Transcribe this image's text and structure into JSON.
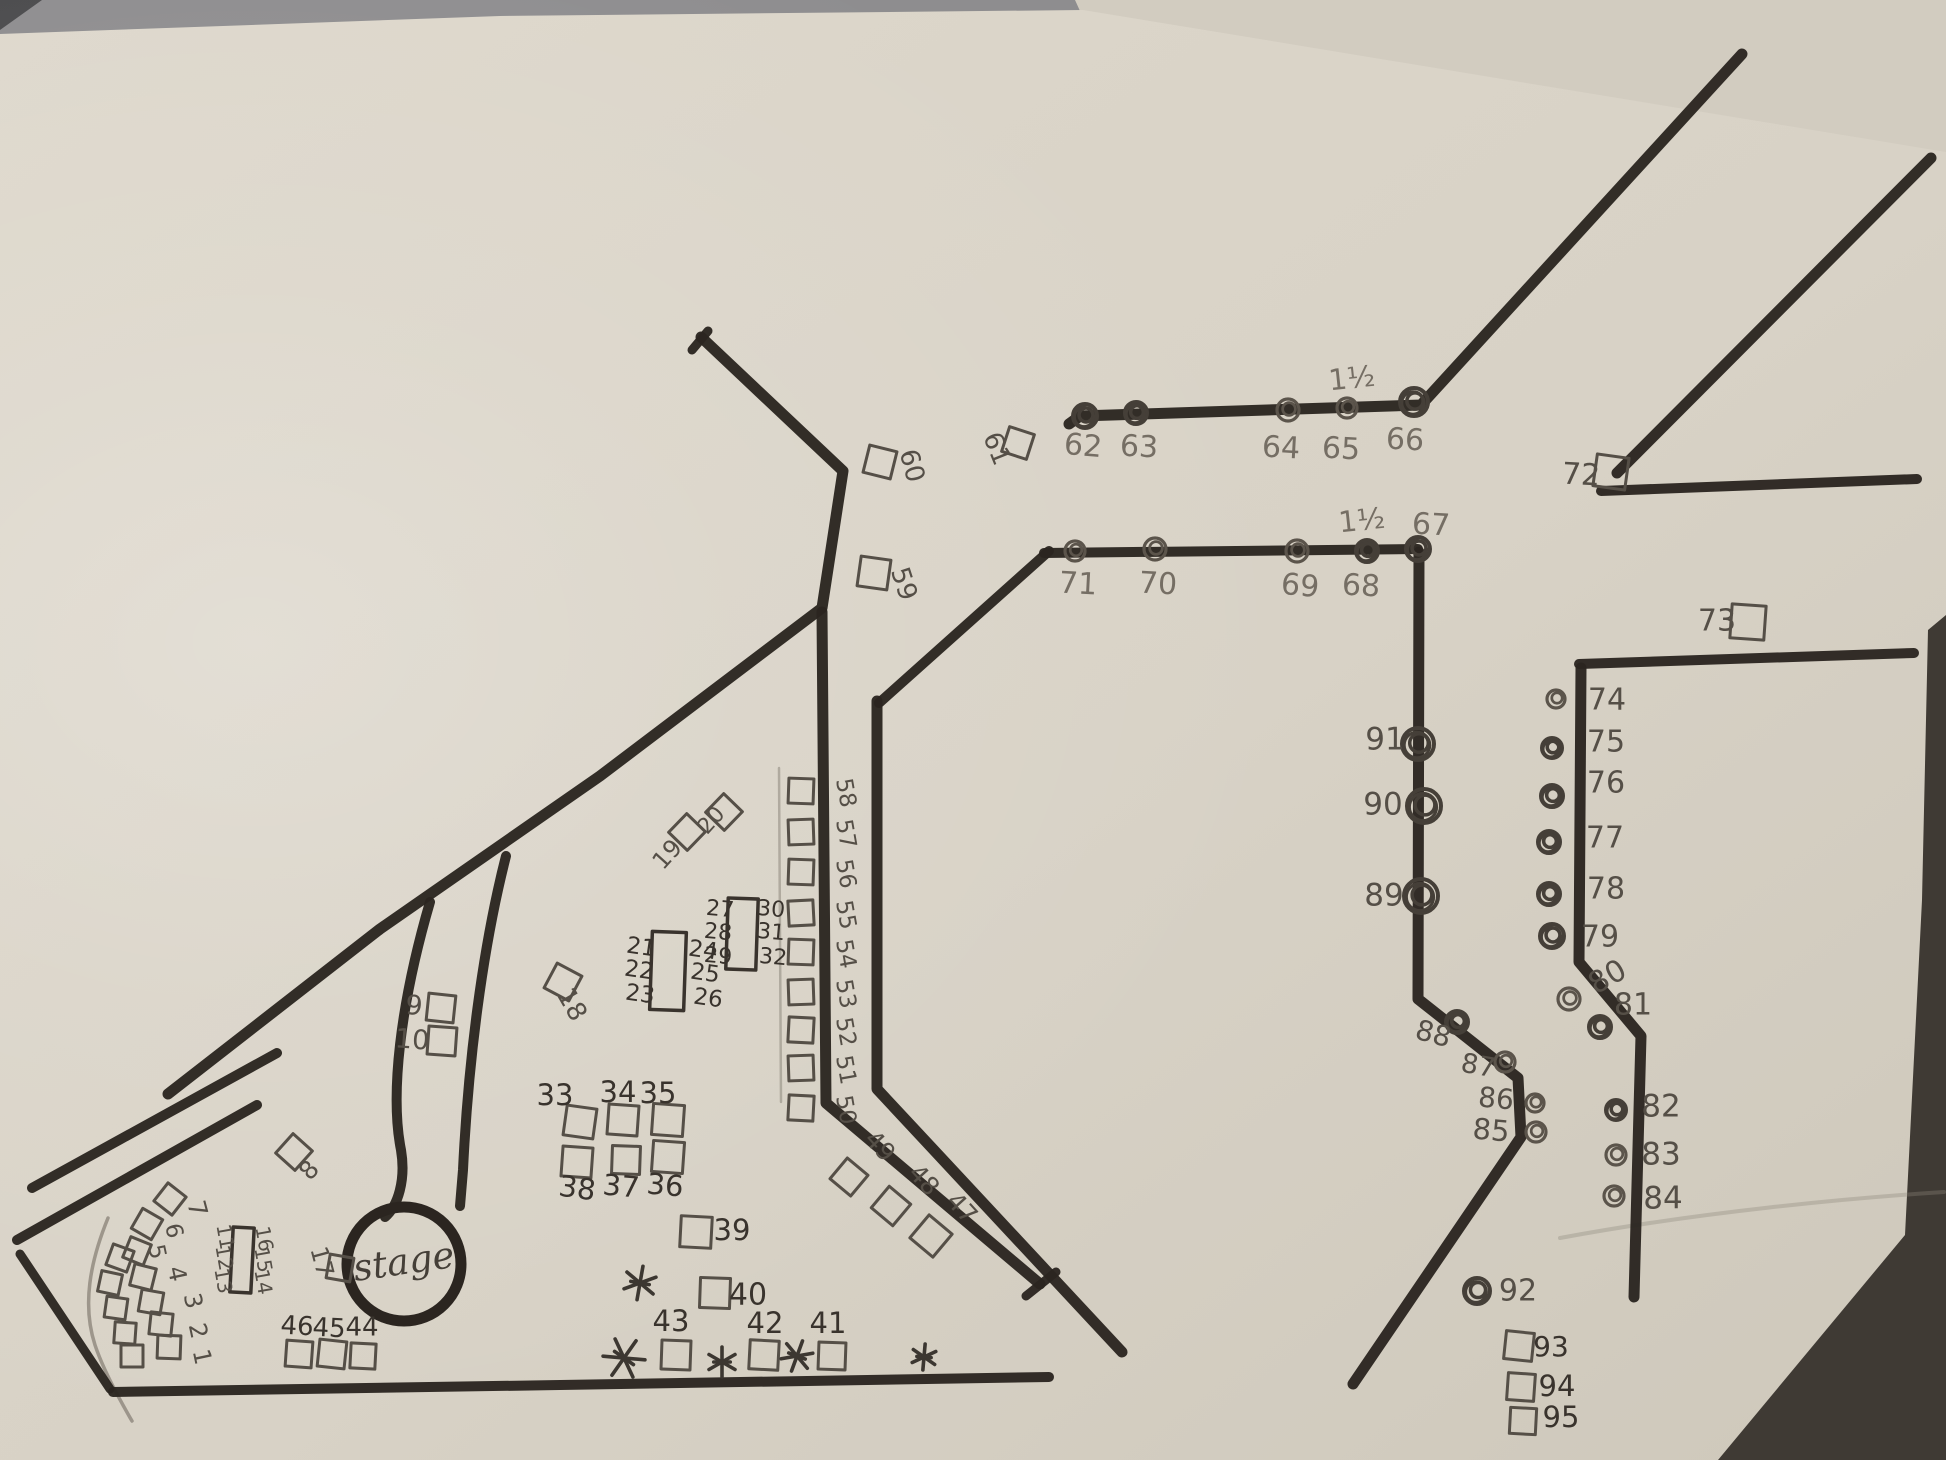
{
  "scene": {
    "width": 1946,
    "height": 1460,
    "paper_color": "#dad4c8",
    "paper_shade": "#cfc9bd",
    "backing_sheet_color": "#d2ccc0",
    "table_strip_color": "#8e8d8f",
    "dark_edge_color": "#3f3a34",
    "marker_color": "#2b2520",
    "pen_colors": {
      "p": "#756e64",
      "m": "#554f47",
      "d": "#39332d"
    }
  },
  "stage": {
    "label": "stage",
    "x": 404,
    "y": 1264,
    "r": 57,
    "label_rot": -8,
    "label_size": 37
  },
  "annotations": [
    {
      "t": "1½",
      "x": 1352,
      "y": 380,
      "r": -6,
      "s": 29,
      "p": "p"
    },
    {
      "t": "1½",
      "x": 1362,
      "y": 522,
      "r": -6,
      "s": 29,
      "p": "p"
    }
  ],
  "walls": [
    {
      "n": "top-left-tick",
      "d": "M 692,350 L 708,331",
      "w": 9
    },
    {
      "n": "main-diagonal",
      "d": "M 701,337 L 843,471 L 822,608 L 600,776 L 380,929 L 168,1094",
      "w": 11
    },
    {
      "n": "stage-corridor-left",
      "d": "M 430,902 C 400,1005 390,1095 401,1150 C 406,1180 398,1206 385,1217",
      "w": 10
    },
    {
      "n": "stage-corridor-right",
      "d": "M 506,856 C 482,950 468,1065 463,1170 L 460,1206",
      "w": 10
    },
    {
      "n": "corridor-left-wall",
      "d": "M 822,612 L 826,1103 L 1040,1284",
      "w": 11
    },
    {
      "n": "corridor-left-foot",
      "d": "M 1026,1296 L 1056,1272",
      "w": 9
    },
    {
      "n": "octagon-left-wall",
      "d": "M 877,701 L 877,1089 L 1122,1352",
      "w": 11
    },
    {
      "n": "octagon-nw-wall",
      "d": "M 879,703 L 1049,551",
      "w": 10
    },
    {
      "n": "octagon-top-wall",
      "d": "M 1044,553 L 1418,549",
      "w": 10
    },
    {
      "n": "octagon-right-wall",
      "d": "M 1419,552 L 1418,999 L 1518,1078 L 1521,1137 L 1353,1384",
      "w": 11
    },
    {
      "n": "top-row-wall",
      "d": "M 1069,424 L 1080,416 L 1421,405 L 1742,54",
      "w": 11
    },
    {
      "n": "upper-right-diagonal",
      "d": "M 1931,158 L 1617,473",
      "w": 11
    },
    {
      "n": "upper-right-horizontal",
      "d": "M 1601,491 L 1917,479",
      "w": 10
    },
    {
      "n": "right-area-top-wall",
      "d": "M 1579,664 L 1914,653",
      "w": 10
    },
    {
      "n": "right-area-side-wall",
      "d": "M 1581,668 L 1579,962 L 1641,1036 L 1634,1297",
      "w": 11
    },
    {
      "n": "bottom-wall",
      "d": "M 113,1392 L 560,1385 L 1049,1377",
      "w": 10
    },
    {
      "n": "left-corner-upper",
      "d": "M 277,1053 L 32,1188",
      "w": 10
    },
    {
      "n": "left-corner-lower",
      "d": "M 257,1105 L 17,1240",
      "w": 10
    },
    {
      "n": "left-corner-return",
      "d": "M 20,1254 L 110,1389",
      "w": 9
    }
  ],
  "pencil_marks": [
    {
      "n": "pencil-arc",
      "d": "M 108,1218 C 90,1262 82,1305 95,1345 C 102,1366 114,1390 132,1421",
      "w": 3.5,
      "o": 0.8
    },
    {
      "n": "pencil-column-guide",
      "d": "M 779,768 L 781,1102",
      "w": 2.5,
      "o": 0.55
    },
    {
      "n": "paper-crease",
      "d": "M 1560,1238 C 1700,1212 1850,1198 1944,1192",
      "w": 4,
      "o": 0.35
    }
  ],
  "booth_squares": [
    [
      120,
      1258,
      22,
      20
    ],
    [
      110,
      1283,
      21,
      12
    ],
    [
      116,
      1308,
      21,
      8
    ],
    [
      125,
      1333,
      21,
      4
    ],
    [
      132,
      1356,
      22,
      0
    ],
    [
      170,
      1199,
      23,
      38
    ],
    [
      147,
      1224,
      23,
      30
    ],
    [
      137,
      1251,
      22,
      22
    ],
    [
      143,
      1277,
      22,
      14
    ],
    [
      151,
      1302,
      22,
      10
    ],
    [
      161,
      1324,
      22,
      6
    ],
    [
      169,
      1347,
      23,
      2
    ],
    [
      294,
      1152,
      26,
      42
    ],
    [
      441,
      1008,
      27,
      6
    ],
    [
      442,
      1041,
      28,
      4
    ],
    [
      340,
      1268,
      24,
      10
    ],
    [
      563,
      982,
      28,
      28
    ],
    [
      687,
      832,
      26,
      44
    ],
    [
      724,
      812,
      26,
      44
    ],
    [
      580,
      1122,
      30,
      8
    ],
    [
      623,
      1120,
      30,
      4
    ],
    [
      668,
      1120,
      31,
      4
    ],
    [
      577,
      1162,
      30,
      4
    ],
    [
      626,
      1160,
      28,
      2
    ],
    [
      668,
      1157,
      31,
      4
    ],
    [
      696,
      1232,
      31,
      3
    ],
    [
      715,
      1293,
      30,
      2
    ],
    [
      676,
      1355,
      29,
      2
    ],
    [
      764,
      1355,
      29,
      3
    ],
    [
      832,
      1356,
      27,
      2
    ],
    [
      299,
      1354,
      26,
      4
    ],
    [
      332,
      1354,
      27,
      6
    ],
    [
      363,
      1356,
      25,
      3
    ],
    [
      849,
      1177,
      27,
      40
    ],
    [
      891,
      1206,
      28,
      40
    ],
    [
      931,
      1236,
      30,
      40
    ],
    [
      801,
      1108,
      25,
      3
    ],
    [
      801,
      1068,
      25,
      -2
    ],
    [
      801,
      1030,
      25,
      3
    ],
    [
      801,
      992,
      25,
      -2
    ],
    [
      801,
      952,
      25,
      2
    ],
    [
      801,
      913,
      25,
      -3
    ],
    [
      801,
      872,
      25,
      2
    ],
    [
      801,
      832,
      25,
      -2
    ],
    [
      801,
      791,
      25,
      2
    ],
    [
      874,
      573,
      30,
      8
    ],
    [
      880,
      462,
      28,
      14
    ],
    [
      1018,
      443,
      26,
      18
    ],
    [
      1611,
      472,
      32,
      8
    ],
    [
      1748,
      622,
      34,
      4
    ],
    [
      1519,
      1346,
      28,
      6
    ],
    [
      1521,
      1387,
      27,
      4
    ],
    [
      1523,
      1421,
      26,
      3
    ]
  ],
  "booth_tables": [
    {
      "n": "table-11-16",
      "x": 242,
      "y": 1260,
      "w": 21,
      "h": 65,
      "r": 3
    },
    {
      "n": "table-21-26",
      "x": 668,
      "y": 971,
      "w": 34,
      "h": 78,
      "r": 2
    },
    {
      "n": "table-27-32",
      "x": 742,
      "y": 934,
      "w": 30,
      "h": 71,
      "r": 2
    }
  ],
  "booth_dots": [
    [
      1085,
      416,
      12,
      1
    ],
    [
      1136,
      413,
      11,
      1
    ],
    [
      1288,
      410,
      11,
      0
    ],
    [
      1347,
      408,
      10,
      0
    ],
    [
      1414,
      402,
      14,
      1
    ],
    [
      1418,
      549,
      12,
      1
    ],
    [
      1367,
      551,
      11,
      1
    ],
    [
      1297,
      551,
      11,
      0
    ],
    [
      1155,
      549,
      11,
      0
    ],
    [
      1075,
      551,
      10,
      0
    ],
    [
      1556,
      699,
      9,
      0
    ],
    [
      1552,
      748,
      10,
      1
    ],
    [
      1552,
      796,
      11,
      1
    ],
    [
      1549,
      842,
      11,
      1
    ],
    [
      1549,
      894,
      11,
      1
    ],
    [
      1552,
      936,
      12,
      1
    ],
    [
      1569,
      999,
      11,
      0
    ],
    [
      1600,
      1027,
      11,
      1
    ],
    [
      1616,
      1110,
      10,
      1
    ],
    [
      1616,
      1155,
      10,
      0
    ],
    [
      1614,
      1196,
      10,
      0
    ],
    [
      1536,
      1132,
      10,
      0
    ],
    [
      1535,
      1103,
      9,
      0
    ],
    [
      1505,
      1062,
      10,
      0
    ],
    [
      1457,
      1022,
      11,
      1
    ],
    [
      1421,
      896,
      17,
      1
    ],
    [
      1424,
      806,
      17,
      1
    ],
    [
      1418,
      744,
      16,
      1
    ],
    [
      1477,
      1291,
      13,
      1
    ]
  ],
  "labels": [
    {
      "t": "1",
      "x": 201,
      "y": 1357,
      "r": 78,
      "s": 24,
      "p": "m"
    },
    {
      "t": "2",
      "x": 197,
      "y": 1331,
      "r": 78,
      "s": 24,
      "p": "m"
    },
    {
      "t": "3",
      "x": 192,
      "y": 1301,
      "r": 78,
      "s": 24,
      "p": "m"
    },
    {
      "t": "4",
      "x": 176,
      "y": 1274,
      "r": 78,
      "s": 24,
      "p": "m"
    },
    {
      "t": "5",
      "x": 156,
      "y": 1252,
      "r": 78,
      "s": 23,
      "p": "m"
    },
    {
      "t": "6",
      "x": 173,
      "y": 1231,
      "r": 78,
      "s": 23,
      "p": "m"
    },
    {
      "t": "7",
      "x": 196,
      "y": 1209,
      "r": 75,
      "s": 25,
      "p": "m"
    },
    {
      "t": "8",
      "x": 310,
      "y": 1171,
      "r": -48,
      "s": 25,
      "p": "m"
    },
    {
      "t": "9",
      "x": 414,
      "y": 1007,
      "r": 4,
      "s": 27,
      "p": "m"
    },
    {
      "t": "10",
      "x": 412,
      "y": 1041,
      "r": 4,
      "s": 27,
      "p": "m"
    },
    {
      "t": "11",
      "x": 224,
      "y": 1237,
      "r": 80,
      "s": 20,
      "p": "m"
    },
    {
      "t": "12",
      "x": 223,
      "y": 1258,
      "r": 80,
      "s": 20,
      "p": "m"
    },
    {
      "t": "13",
      "x": 222,
      "y": 1281,
      "r": 80,
      "s": 20,
      "p": "m"
    },
    {
      "t": "16",
      "x": 263,
      "y": 1239,
      "r": 80,
      "s": 20,
      "p": "m"
    },
    {
      "t": "15",
      "x": 262,
      "y": 1260,
      "r": 80,
      "s": 20,
      "p": "m"
    },
    {
      "t": "14",
      "x": 262,
      "y": 1282,
      "r": 80,
      "s": 20,
      "p": "m"
    },
    {
      "t": "17",
      "x": 321,
      "y": 1262,
      "r": 75,
      "s": 24,
      "p": "m"
    },
    {
      "t": "18",
      "x": 571,
      "y": 1005,
      "r": 60,
      "s": 26,
      "p": "m"
    },
    {
      "t": "19",
      "x": 668,
      "y": 855,
      "r": -48,
      "s": 24,
      "p": "m"
    },
    {
      "t": "20",
      "x": 712,
      "y": 821,
      "r": -48,
      "s": 22,
      "p": "m"
    },
    {
      "t": "21",
      "x": 641,
      "y": 948,
      "r": 8,
      "s": 23,
      "p": "d"
    },
    {
      "t": "22",
      "x": 639,
      "y": 971,
      "r": 8,
      "s": 23,
      "p": "d"
    },
    {
      "t": "23",
      "x": 640,
      "y": 995,
      "r": 8,
      "s": 23,
      "p": "d"
    },
    {
      "t": "24",
      "x": 703,
      "y": 951,
      "r": 8,
      "s": 23,
      "p": "d"
    },
    {
      "t": "25",
      "x": 705,
      "y": 974,
      "r": 8,
      "s": 23,
      "p": "d"
    },
    {
      "t": "26",
      "x": 708,
      "y": 999,
      "r": 8,
      "s": 23,
      "p": "d"
    },
    {
      "t": "27",
      "x": 720,
      "y": 910,
      "r": 5,
      "s": 22,
      "p": "d"
    },
    {
      "t": "28",
      "x": 718,
      "y": 933,
      "r": 5,
      "s": 22,
      "p": "d"
    },
    {
      "t": "29",
      "x": 718,
      "y": 957,
      "r": 5,
      "s": 22,
      "p": "d"
    },
    {
      "t": "30",
      "x": 771,
      "y": 910,
      "r": 5,
      "s": 22,
      "p": "d"
    },
    {
      "t": "31",
      "x": 771,
      "y": 933,
      "r": 5,
      "s": 22,
      "p": "d"
    },
    {
      "t": "32",
      "x": 773,
      "y": 958,
      "r": 5,
      "s": 22,
      "p": "d"
    },
    {
      "t": "33",
      "x": 555,
      "y": 1097,
      "r": 0,
      "s": 29,
      "p": "d"
    },
    {
      "t": "34",
      "x": 618,
      "y": 1094,
      "r": 0,
      "s": 29,
      "p": "d"
    },
    {
      "t": "35",
      "x": 658,
      "y": 1095,
      "r": 0,
      "s": 29,
      "p": "d"
    },
    {
      "t": "36",
      "x": 665,
      "y": 1187,
      "r": 5,
      "s": 29,
      "p": "d"
    },
    {
      "t": "37",
      "x": 621,
      "y": 1188,
      "r": 5,
      "s": 29,
      "p": "d"
    },
    {
      "t": "38",
      "x": 577,
      "y": 1190,
      "r": 8,
      "s": 29,
      "p": "d"
    },
    {
      "t": "39",
      "x": 732,
      "y": 1232,
      "r": 0,
      "s": 29,
      "p": "d"
    },
    {
      "t": "40",
      "x": 748,
      "y": 1296,
      "r": 0,
      "s": 30,
      "p": "d"
    },
    {
      "t": "41",
      "x": 828,
      "y": 1325,
      "r": 0,
      "s": 29,
      "p": "d"
    },
    {
      "t": "42",
      "x": 765,
      "y": 1325,
      "r": 0,
      "s": 29,
      "p": "d"
    },
    {
      "t": "43",
      "x": 671,
      "y": 1323,
      "r": 0,
      "s": 29,
      "p": "d"
    },
    {
      "t": "44",
      "x": 362,
      "y": 1328,
      "r": 0,
      "s": 26,
      "p": "d"
    },
    {
      "t": "45",
      "x": 329,
      "y": 1329,
      "r": 3,
      "s": 26,
      "p": "d"
    },
    {
      "t": "46",
      "x": 297,
      "y": 1327,
      "r": 3,
      "s": 26,
      "p": "d"
    },
    {
      "t": "47",
      "x": 961,
      "y": 1209,
      "r": 48,
      "s": 25,
      "p": "m"
    },
    {
      "t": "48",
      "x": 923,
      "y": 1181,
      "r": 48,
      "s": 25,
      "p": "m"
    },
    {
      "t": "49",
      "x": 879,
      "y": 1147,
      "r": 48,
      "s": 25,
      "p": "m"
    },
    {
      "t": "50",
      "x": 845,
      "y": 1110,
      "r": 80,
      "s": 23,
      "p": "m"
    },
    {
      "t": "51",
      "x": 845,
      "y": 1070,
      "r": 80,
      "s": 23,
      "p": "m"
    },
    {
      "t": "52",
      "x": 845,
      "y": 1032,
      "r": 80,
      "s": 23,
      "p": "m"
    },
    {
      "t": "53",
      "x": 845,
      "y": 994,
      "r": 80,
      "s": 23,
      "p": "m"
    },
    {
      "t": "54",
      "x": 845,
      "y": 954,
      "r": 80,
      "s": 23,
      "p": "m"
    },
    {
      "t": "55",
      "x": 845,
      "y": 915,
      "r": 80,
      "s": 23,
      "p": "m"
    },
    {
      "t": "56",
      "x": 845,
      "y": 874,
      "r": 80,
      "s": 23,
      "p": "m"
    },
    {
      "t": "57",
      "x": 845,
      "y": 834,
      "r": 80,
      "s": 23,
      "p": "m"
    },
    {
      "t": "58",
      "x": 845,
      "y": 793,
      "r": 80,
      "s": 23,
      "p": "m"
    },
    {
      "t": "59",
      "x": 903,
      "y": 584,
      "r": 72,
      "s": 26,
      "p": "m"
    },
    {
      "t": "60",
      "x": 911,
      "y": 466,
      "r": 75,
      "s": 26,
      "p": "m"
    },
    {
      "t": "61",
      "x": 996,
      "y": 449,
      "r": 68,
      "s": 26,
      "p": "m"
    },
    {
      "t": "62",
      "x": 1083,
      "y": 447,
      "r": 5,
      "s": 30,
      "p": "p"
    },
    {
      "t": "63",
      "x": 1139,
      "y": 448,
      "r": 3,
      "s": 30,
      "p": "p"
    },
    {
      "t": "64",
      "x": 1281,
      "y": 449,
      "r": 3,
      "s": 30,
      "p": "p"
    },
    {
      "t": "65",
      "x": 1341,
      "y": 450,
      "r": 3,
      "s": 30,
      "p": "p"
    },
    {
      "t": "66",
      "x": 1405,
      "y": 441,
      "r": 3,
      "s": 30,
      "p": "p"
    },
    {
      "t": "67",
      "x": 1431,
      "y": 526,
      "r": 3,
      "s": 30,
      "p": "p"
    },
    {
      "t": "68",
      "x": 1361,
      "y": 587,
      "r": 3,
      "s": 30,
      "p": "p"
    },
    {
      "t": "69",
      "x": 1300,
      "y": 587,
      "r": 5,
      "s": 30,
      "p": "p"
    },
    {
      "t": "70",
      "x": 1158,
      "y": 585,
      "r": 3,
      "s": 30,
      "p": "p"
    },
    {
      "t": "71",
      "x": 1078,
      "y": 585,
      "r": 3,
      "s": 30,
      "p": "p"
    },
    {
      "t": "72",
      "x": 1581,
      "y": 476,
      "r": 3,
      "s": 30,
      "p": "m"
    },
    {
      "t": "73",
      "x": 1717,
      "y": 622,
      "r": 0,
      "s": 30,
      "p": "m"
    },
    {
      "t": "74",
      "x": 1607,
      "y": 701,
      "r": 0,
      "s": 30,
      "p": "m"
    },
    {
      "t": "75",
      "x": 1606,
      "y": 743,
      "r": 0,
      "s": 30,
      "p": "m"
    },
    {
      "t": "76",
      "x": 1606,
      "y": 784,
      "r": 0,
      "s": 30,
      "p": "m"
    },
    {
      "t": "77",
      "x": 1605,
      "y": 839,
      "r": 0,
      "s": 30,
      "p": "m"
    },
    {
      "t": "78",
      "x": 1606,
      "y": 890,
      "r": 0,
      "s": 30,
      "p": "m"
    },
    {
      "t": "79",
      "x": 1600,
      "y": 938,
      "r": 0,
      "s": 30,
      "p": "m"
    },
    {
      "t": "80",
      "x": 1608,
      "y": 978,
      "r": -30,
      "s": 30,
      "p": "m"
    },
    {
      "t": "81",
      "x": 1633,
      "y": 1006,
      "r": 0,
      "s": 30,
      "p": "m"
    },
    {
      "t": "82",
      "x": 1661,
      "y": 1108,
      "r": 0,
      "s": 31,
      "p": "m"
    },
    {
      "t": "83",
      "x": 1661,
      "y": 1156,
      "r": 0,
      "s": 31,
      "p": "m"
    },
    {
      "t": "84",
      "x": 1663,
      "y": 1200,
      "r": 0,
      "s": 31,
      "p": "m"
    },
    {
      "t": "85",
      "x": 1491,
      "y": 1132,
      "r": 5,
      "s": 29,
      "p": "m"
    },
    {
      "t": "86",
      "x": 1496,
      "y": 1100,
      "r": 5,
      "s": 28,
      "p": "m"
    },
    {
      "t": "87",
      "x": 1478,
      "y": 1067,
      "r": 10,
      "s": 27,
      "p": "m"
    },
    {
      "t": "88",
      "x": 1433,
      "y": 1035,
      "r": 15,
      "s": 28,
      "p": "m"
    },
    {
      "t": "89",
      "x": 1384,
      "y": 897,
      "r": 0,
      "s": 31,
      "p": "m"
    },
    {
      "t": "90",
      "x": 1383,
      "y": 806,
      "r": 0,
      "s": 31,
      "p": "m"
    },
    {
      "t": "91",
      "x": 1385,
      "y": 741,
      "r": 0,
      "s": 31,
      "p": "m"
    },
    {
      "t": "92",
      "x": 1518,
      "y": 1292,
      "r": 0,
      "s": 30,
      "p": "m"
    },
    {
      "t": "93",
      "x": 1551,
      "y": 1348,
      "r": 0,
      "s": 28,
      "p": "d"
    },
    {
      "t": "94",
      "x": 1557,
      "y": 1388,
      "r": 0,
      "s": 29,
      "p": "d"
    },
    {
      "t": "95",
      "x": 1561,
      "y": 1419,
      "r": 0,
      "s": 29,
      "p": "d"
    }
  ],
  "asterisks": [
    [
      640,
      1283,
      17,
      10
    ],
    [
      624,
      1358,
      21,
      35
    ],
    [
      722,
      1362,
      15,
      0
    ],
    [
      797,
      1356,
      16,
      20
    ],
    [
      924,
      1357,
      13,
      5
    ]
  ]
}
